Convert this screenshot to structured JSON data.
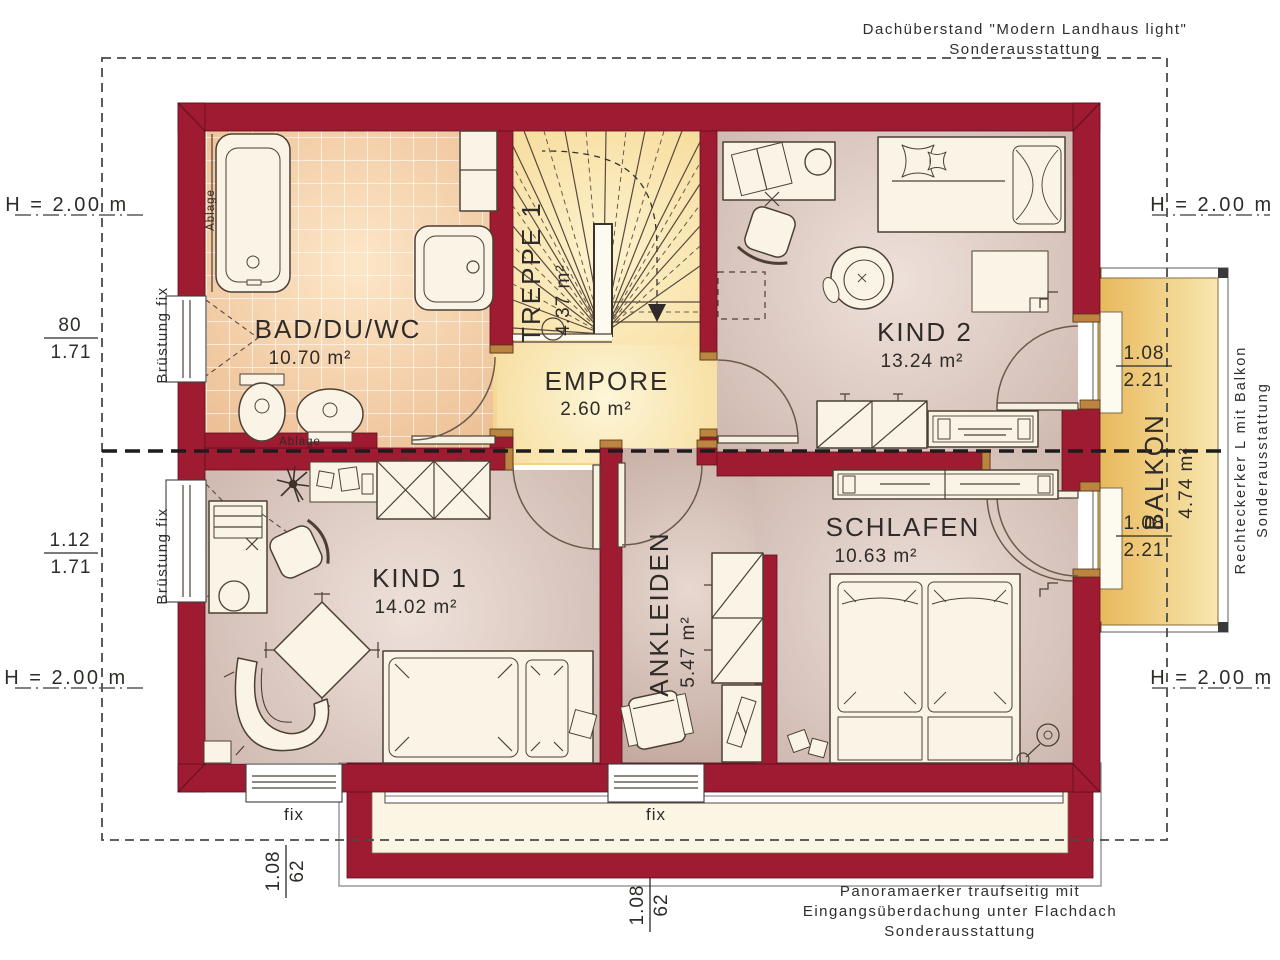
{
  "title": "floor-plan-upper-storey",
  "rooms": {
    "bad": {
      "name": "BAD/DU/WC",
      "area": "10.70 m²"
    },
    "treppe": {
      "name": "TREPPE 1",
      "area": "4.37 m²"
    },
    "empore": {
      "name": "EMPORE",
      "area": "2.60 m²"
    },
    "kind2": {
      "name": "KIND 2",
      "area": "13.24 m²"
    },
    "kind1": {
      "name": "KIND 1",
      "area": "14.02 m²"
    },
    "ankleiden": {
      "name": "ANKLEIDEN",
      "area": "5.47 m²"
    },
    "schlafen": {
      "name": "SCHLAFEN",
      "area": "10.63 m²"
    },
    "balkon": {
      "name": "BALKON",
      "area": "4.74 m²"
    }
  },
  "marks": {
    "height": "H = 2.00 m"
  },
  "dims": {
    "left_upper": {
      "num": "80",
      "den": "1.71"
    },
    "left_lower": {
      "num": "1.12",
      "den": "1.71"
    },
    "balcony": {
      "num": "1.08",
      "den": "2.21"
    },
    "south": {
      "num": "1.08",
      "den": "62"
    }
  },
  "labels": {
    "fix": "fix",
    "bruestung": "Brüstung fix",
    "ablage": "Ablage"
  },
  "annotations": {
    "roof": {
      "line1": "Dachüberstand \"Modern Landhaus light\"",
      "line2": "Sonderausstattung"
    },
    "erker": {
      "line1": "Rechteckerker L mit Balkon",
      "line2": "Sonderausstattung"
    },
    "panorama": {
      "line1": "Panoramaerker traufseitig mit",
      "line2": "Eingangsüberdachung unter Flachdach",
      "line3": "Sonderausstattung"
    }
  },
  "colors": {
    "wall": "#9e1b32",
    "tile": "#edc096",
    "stair_yellow": "#f2cf7e",
    "floor_mauve": "#c9b1a8",
    "balcony": "#e8b85a",
    "text": "#2f2b28"
  }
}
